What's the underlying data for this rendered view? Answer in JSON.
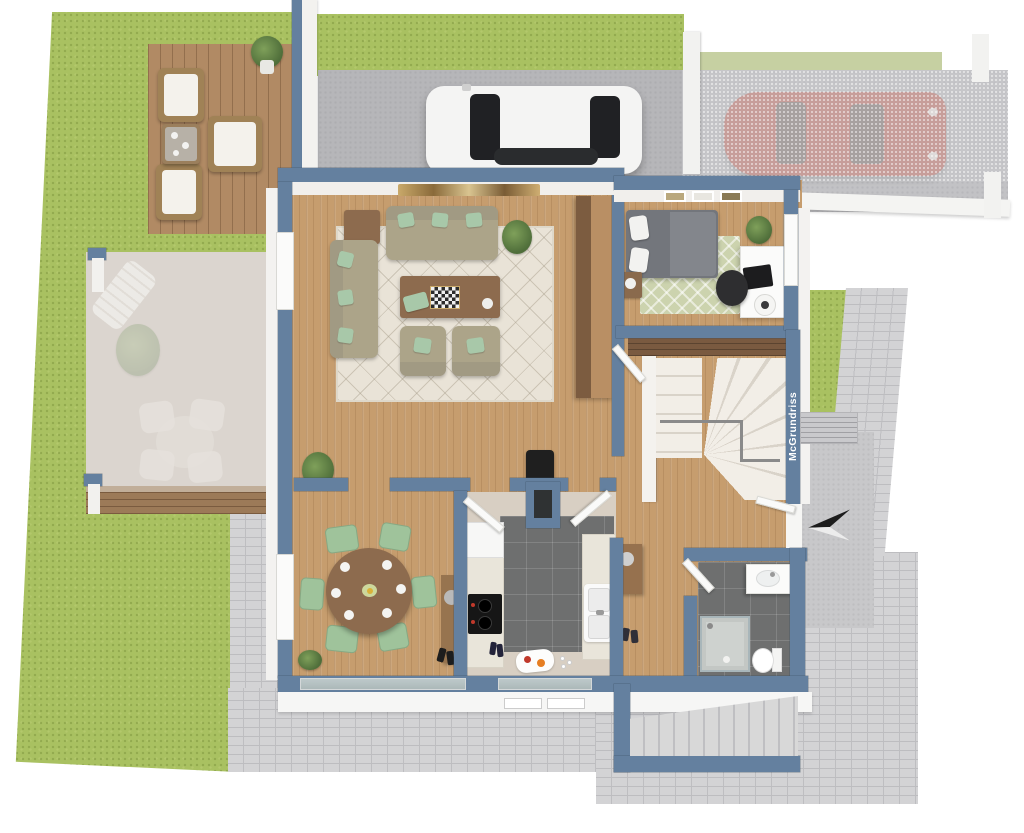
{
  "watermark": {
    "text": "McGrundriss"
  },
  "palette": {
    "background": "#ffffff",
    "grass": "#a9c161",
    "grass_light": "#c6d0a2",
    "deck_wood": "#b18a64",
    "terrace_floor": "#cbc2ba",
    "wall": "#64809f",
    "wood_floor": "#c69d6e",
    "tile_floor": "#6e6f6f",
    "rug_living": "#e9e3d7",
    "rug_bedroom": "#ccd3ae",
    "sofa": "#aca489",
    "pillow_mint": "#a8c8a9",
    "table_wood": "#8d6b4e",
    "chair_green": "#9fc39b",
    "bed": "#73767c",
    "concrete": "#bcbcbf",
    "paving": "#d3d3d5",
    "paving_line": "#bdbdc0",
    "car_white": "#f4f4f3",
    "car_red": "#c5766e",
    "window_dark": "#202124",
    "stair": "#f2eee7",
    "upper_floor": "#7a5a40"
  },
  "scene": {
    "rooms": [
      "living-room",
      "bedroom",
      "kitchen",
      "dining-area",
      "bathroom",
      "hallway-stairs"
    ],
    "exterior": [
      "lawn",
      "wood-deck",
      "covered-terrace",
      "driveway",
      "carport",
      "paved-path",
      "exterior-stairs",
      "entrance"
    ],
    "vehicles": [
      "white-car",
      "red-car"
    ]
  }
}
